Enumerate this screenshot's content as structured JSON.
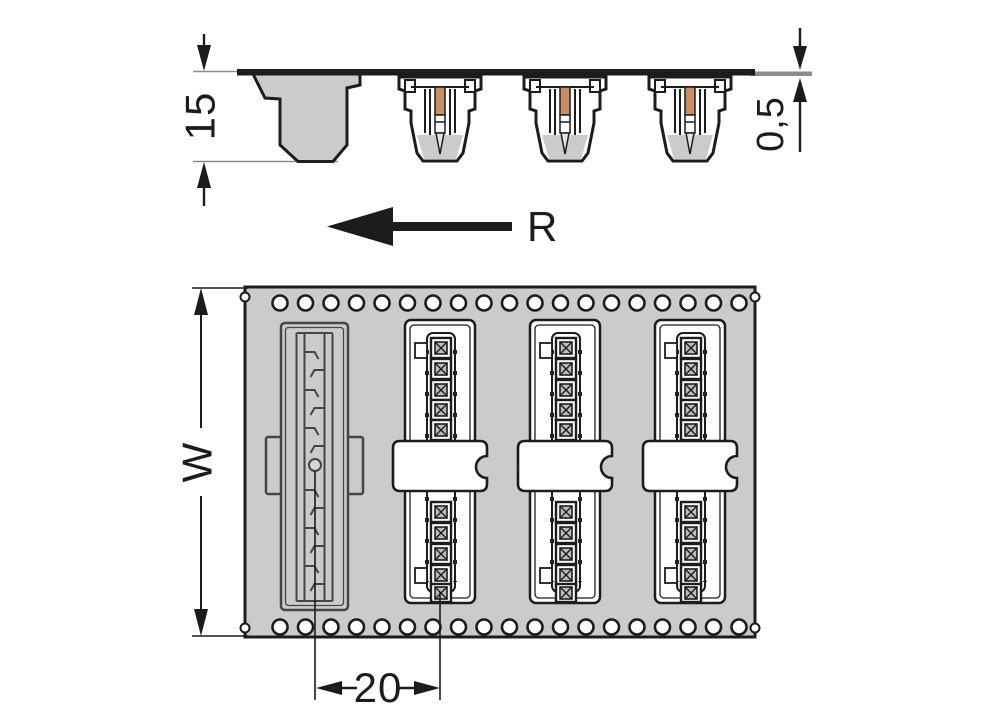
{
  "drawing": {
    "type": "technical-packaging-drawing",
    "views": {
      "side_view": "connector profiles hanging from carrier tape",
      "top_view": "carrier tape with sprocket holes, one empty pocket and three connectors with cover labels"
    }
  },
  "labels": {
    "pocket_depth": "15",
    "tape_thickness": "0,5",
    "unwinding_direction": "R",
    "tape_width": "W",
    "unit_pitch": "20"
  },
  "colors": {
    "ink": "#1c1c1c",
    "tape": "#cbcbcb",
    "thin": "#8c8c8c",
    "copper": "#c78f62",
    "pocketline": "#454545",
    "white": "#ffffff",
    "contactdark": "#222222",
    "contactlight": "#bdbdbd"
  }
}
